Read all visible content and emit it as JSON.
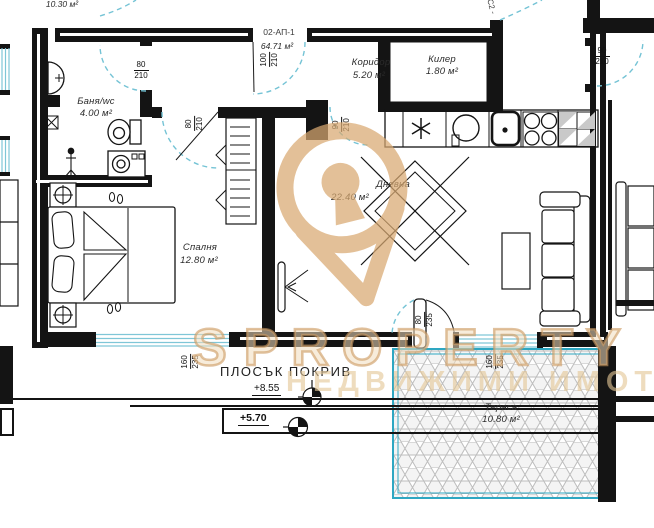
{
  "labels": {
    "apartment_code": "02-АП-1",
    "apartment_area": "64.71 м²",
    "neighbor_area": "10.30 м²",
    "corner_code": "С2 -"
  },
  "rooms": {
    "bathroom": {
      "name": "Баня/wc",
      "area": "4.00 м²"
    },
    "corridor": {
      "name": "Коридор",
      "area": "5.20 м²"
    },
    "storage": {
      "name": "Килер",
      "area": "1.80 м²"
    },
    "living": {
      "name": "Дневна",
      "area": "22.40 м²"
    },
    "bedroom": {
      "name": "Спалня",
      "area": "12.80 м²"
    },
    "terrace": {
      "name": "Тераса",
      "area": "10.80 м²"
    }
  },
  "roof": {
    "label": "ПЛОСЪК ПОКРИВ",
    "level_upper": "+8.55",
    "level_lower": "+5.70"
  },
  "dimensions": {
    "bath_door": {
      "num": "80",
      "den": "210"
    },
    "bedroom_door": {
      "num": "80",
      "den": "210"
    },
    "entrance_door": {
      "num": "100",
      "den": "210"
    },
    "living_passage": {
      "num": "90",
      "den": "210"
    },
    "neighbor_door": {
      "num": "90",
      "den": "210"
    },
    "bedroom_window": {
      "num": "160",
      "den": "235"
    },
    "terrace_window": {
      "num": "160",
      "den": "235"
    },
    "terrace_door": {
      "num": "80",
      "den": "235"
    }
  },
  "watermark": {
    "mark": "S",
    "brand": "PROPERTY",
    "subtitle": "НЕДВИЖИМИ ИМОТИ"
  },
  "colors": {
    "wall": "#141414",
    "door_arc": "#74c3d5",
    "terrace": "#2ea7c2",
    "watermark": "#d9a971"
  }
}
